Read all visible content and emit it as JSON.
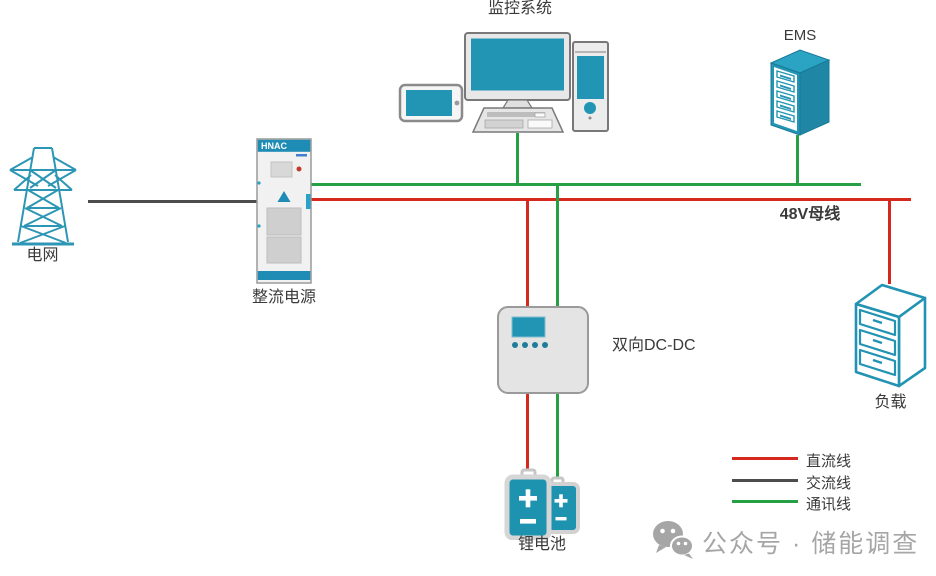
{
  "colors": {
    "dc_line": "#d5291e",
    "ac_line": "#4d4d4d",
    "comm_line": "#27a044",
    "teal": "#2395b4",
    "label_text": "#3a3a3a",
    "watermark": "#a6a6a6"
  },
  "nodes": {
    "grid": {
      "label": "电网"
    },
    "rectifier": {
      "label": "整流电源",
      "brand": "HNAC"
    },
    "monitoring": {
      "label": "监控系统"
    },
    "ems": {
      "label": "EMS"
    },
    "bus": {
      "label": "48V母线"
    },
    "dcdc": {
      "label": "双向DC-DC"
    },
    "load": {
      "label": "负载"
    },
    "battery": {
      "label": "锂电池"
    }
  },
  "legend": {
    "items": [
      {
        "label": "直流线",
        "color": "#d5291e"
      },
      {
        "label": "交流线",
        "color": "#4d4d4d"
      },
      {
        "label": "通讯线",
        "color": "#27a044"
      }
    ]
  },
  "watermark": {
    "text": "公众号 · 储能调查"
  }
}
